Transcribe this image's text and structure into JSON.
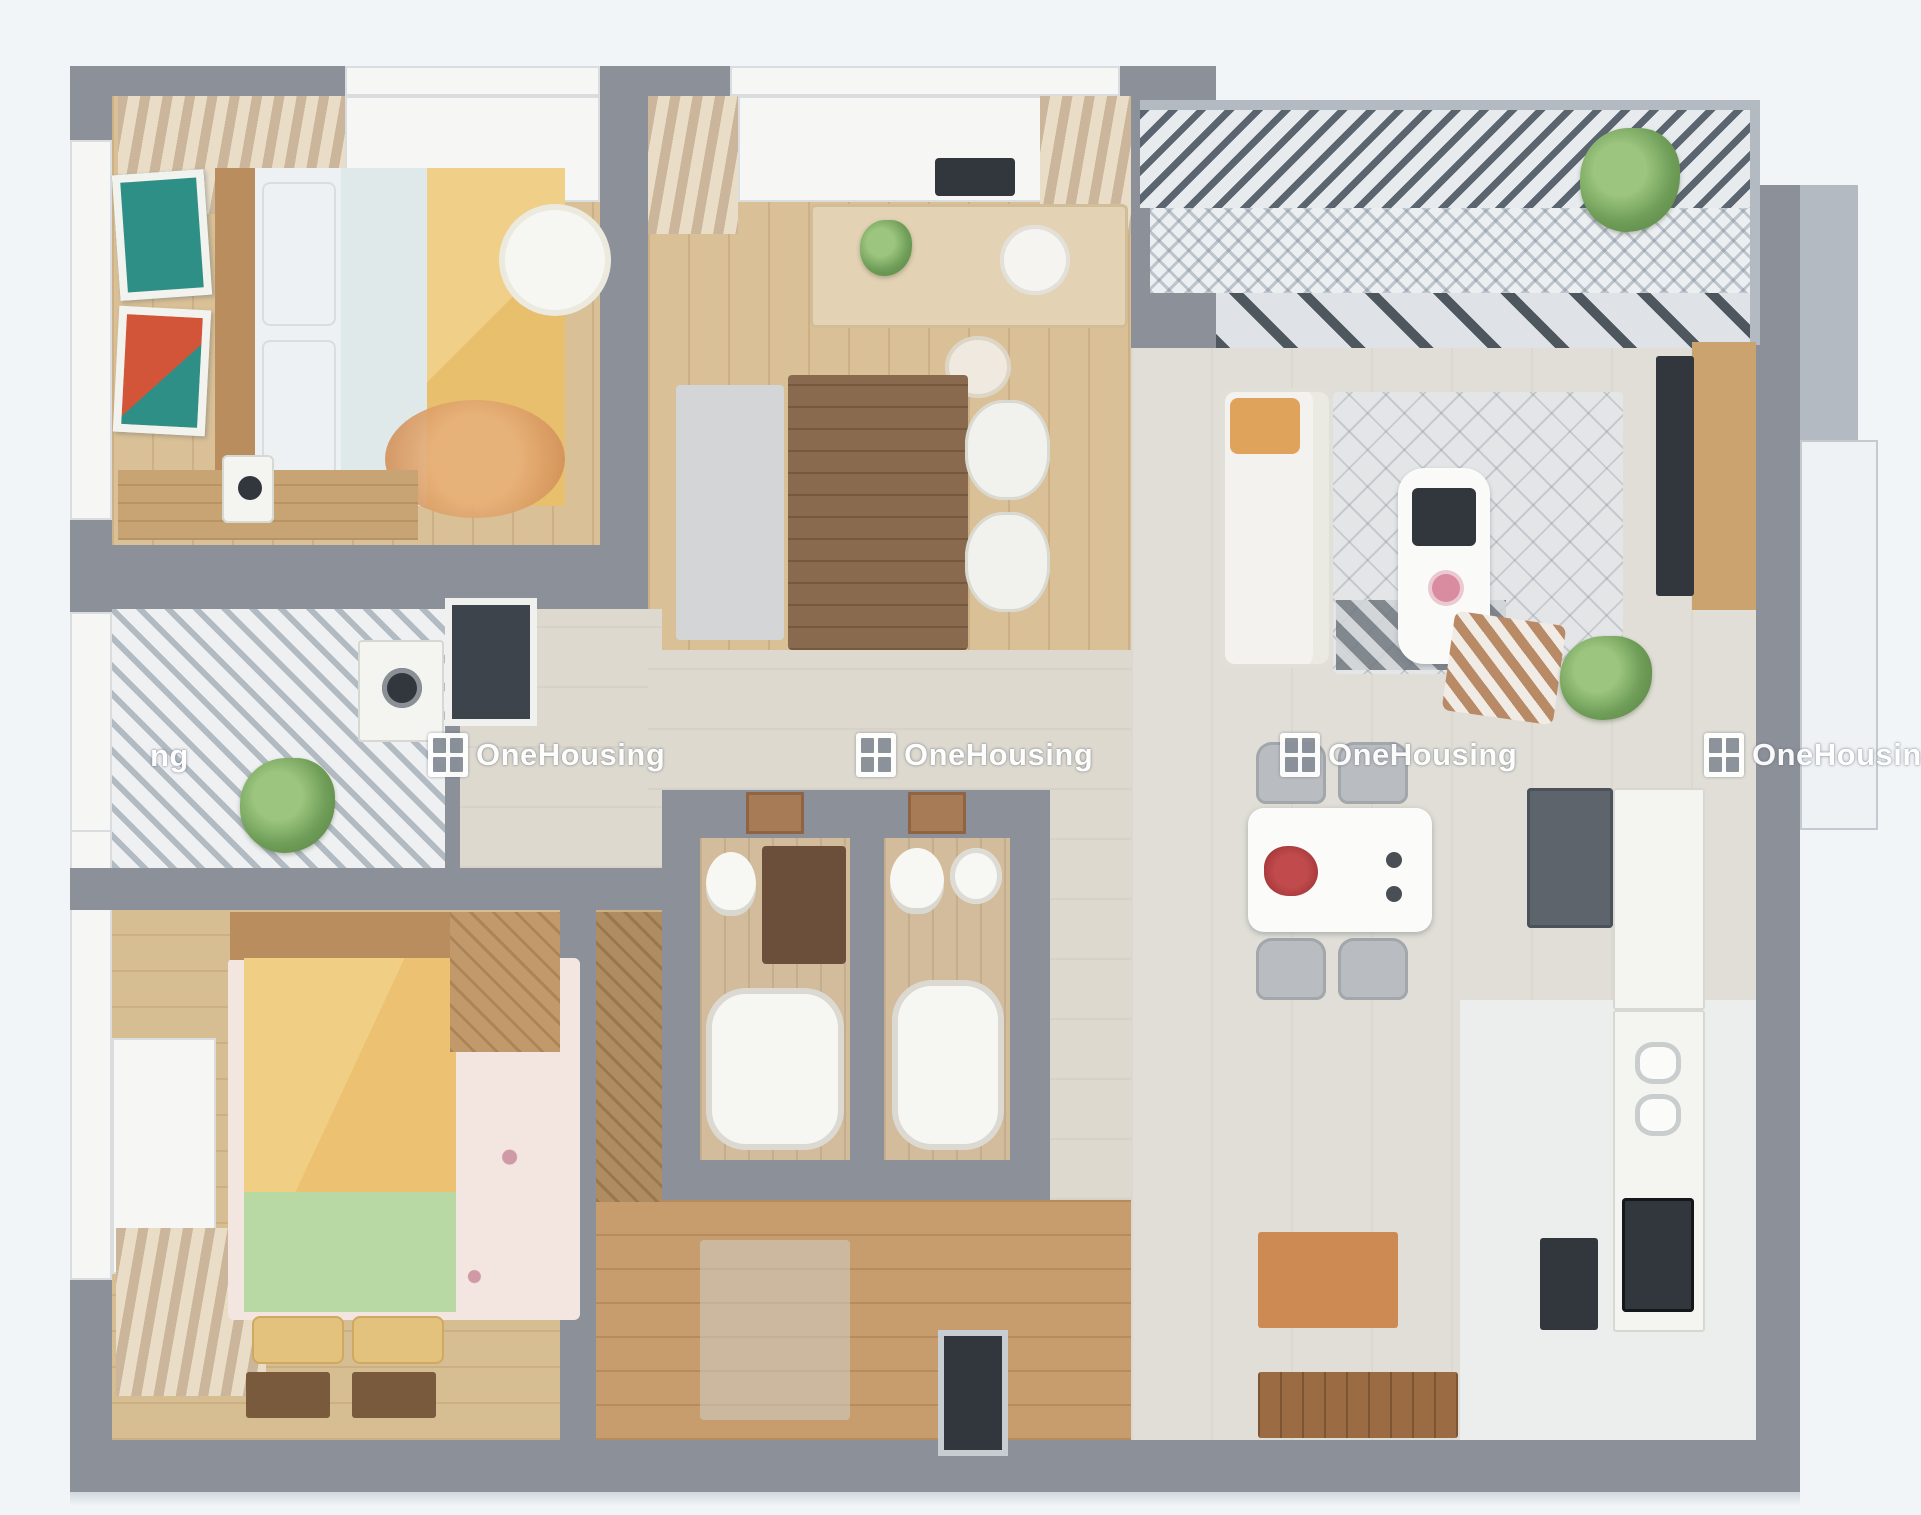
{
  "image_type": "3d-apartment-floor-plan-render",
  "watermark": {
    "label": "OneHousing",
    "fragment": "ng",
    "color": "#ffffff",
    "icon": "window-logo-icon",
    "instances": [
      {
        "x": 150,
        "y": 738,
        "partial": true
      },
      {
        "x": 428,
        "y": 733,
        "partial": false
      },
      {
        "x": 856,
        "y": 733,
        "partial": false
      },
      {
        "x": 1280,
        "y": 733,
        "partial": false
      },
      {
        "x": 1704,
        "y": 733,
        "partial": false
      }
    ]
  },
  "palette": {
    "background": "#f1f5f8",
    "wall_gray": "#8b9099",
    "wall_light": "#b4bac2",
    "floor_wood": "#d9c096",
    "floor_hall": "#ddd9cf",
    "floor_bath_tile": "#d2bc9c",
    "floor_entry_wood": "#c79d6e",
    "floor_kitchen": "#eceeee",
    "bed_blanket_yellow": "#e8bf6d",
    "bed_blanket_green": "#b8d8a4",
    "accent_orange_rug": "#d99a62",
    "sofa_white": "#f3f2ee",
    "plant_green": "#6f9e58",
    "appliance_dark": "#31373d",
    "door_brown": "#a87b57",
    "dining_flower_red": "#a83a3c",
    "watermark_white": "#ffffff"
  }
}
